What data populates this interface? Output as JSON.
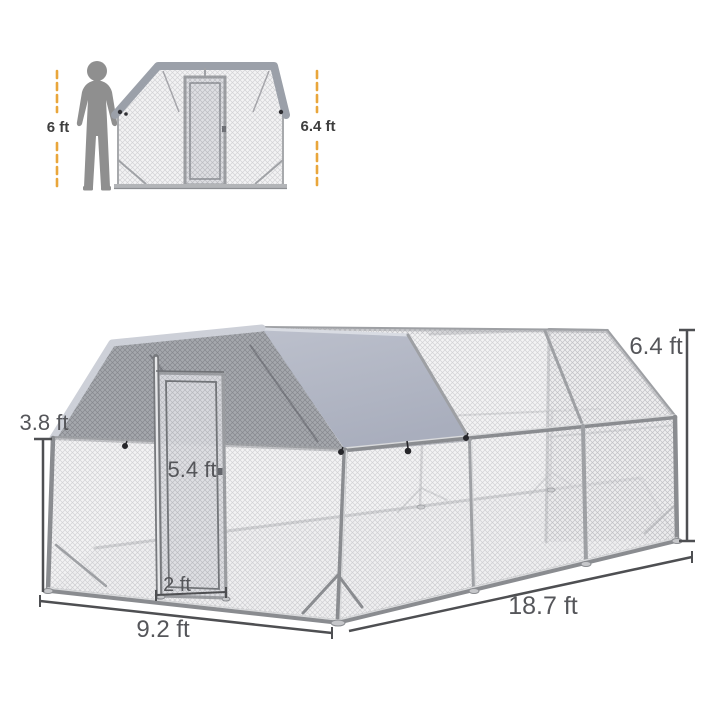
{
  "scale_reference": {
    "person_height": "6 ft",
    "cage_height": "6.4 ft"
  },
  "dimensions": {
    "side_wall_height": "3.8 ft",
    "door_height": "5.4 ft",
    "door_width": "2 ft",
    "width": "9.2 ft",
    "depth": "18.7 ft",
    "total_height": "6.4 ft"
  },
  "colors": {
    "accent_yellow": "#E9A63B",
    "cover_gray": "#B1B6C4",
    "mesh_shade_gray": "#A5A8AD",
    "frame_gray": "#9EA0A4",
    "dimension_text": "#55565A",
    "person_silhouette": "#8F8F8F"
  },
  "icons": {
    "person": "person-silhouette"
  }
}
